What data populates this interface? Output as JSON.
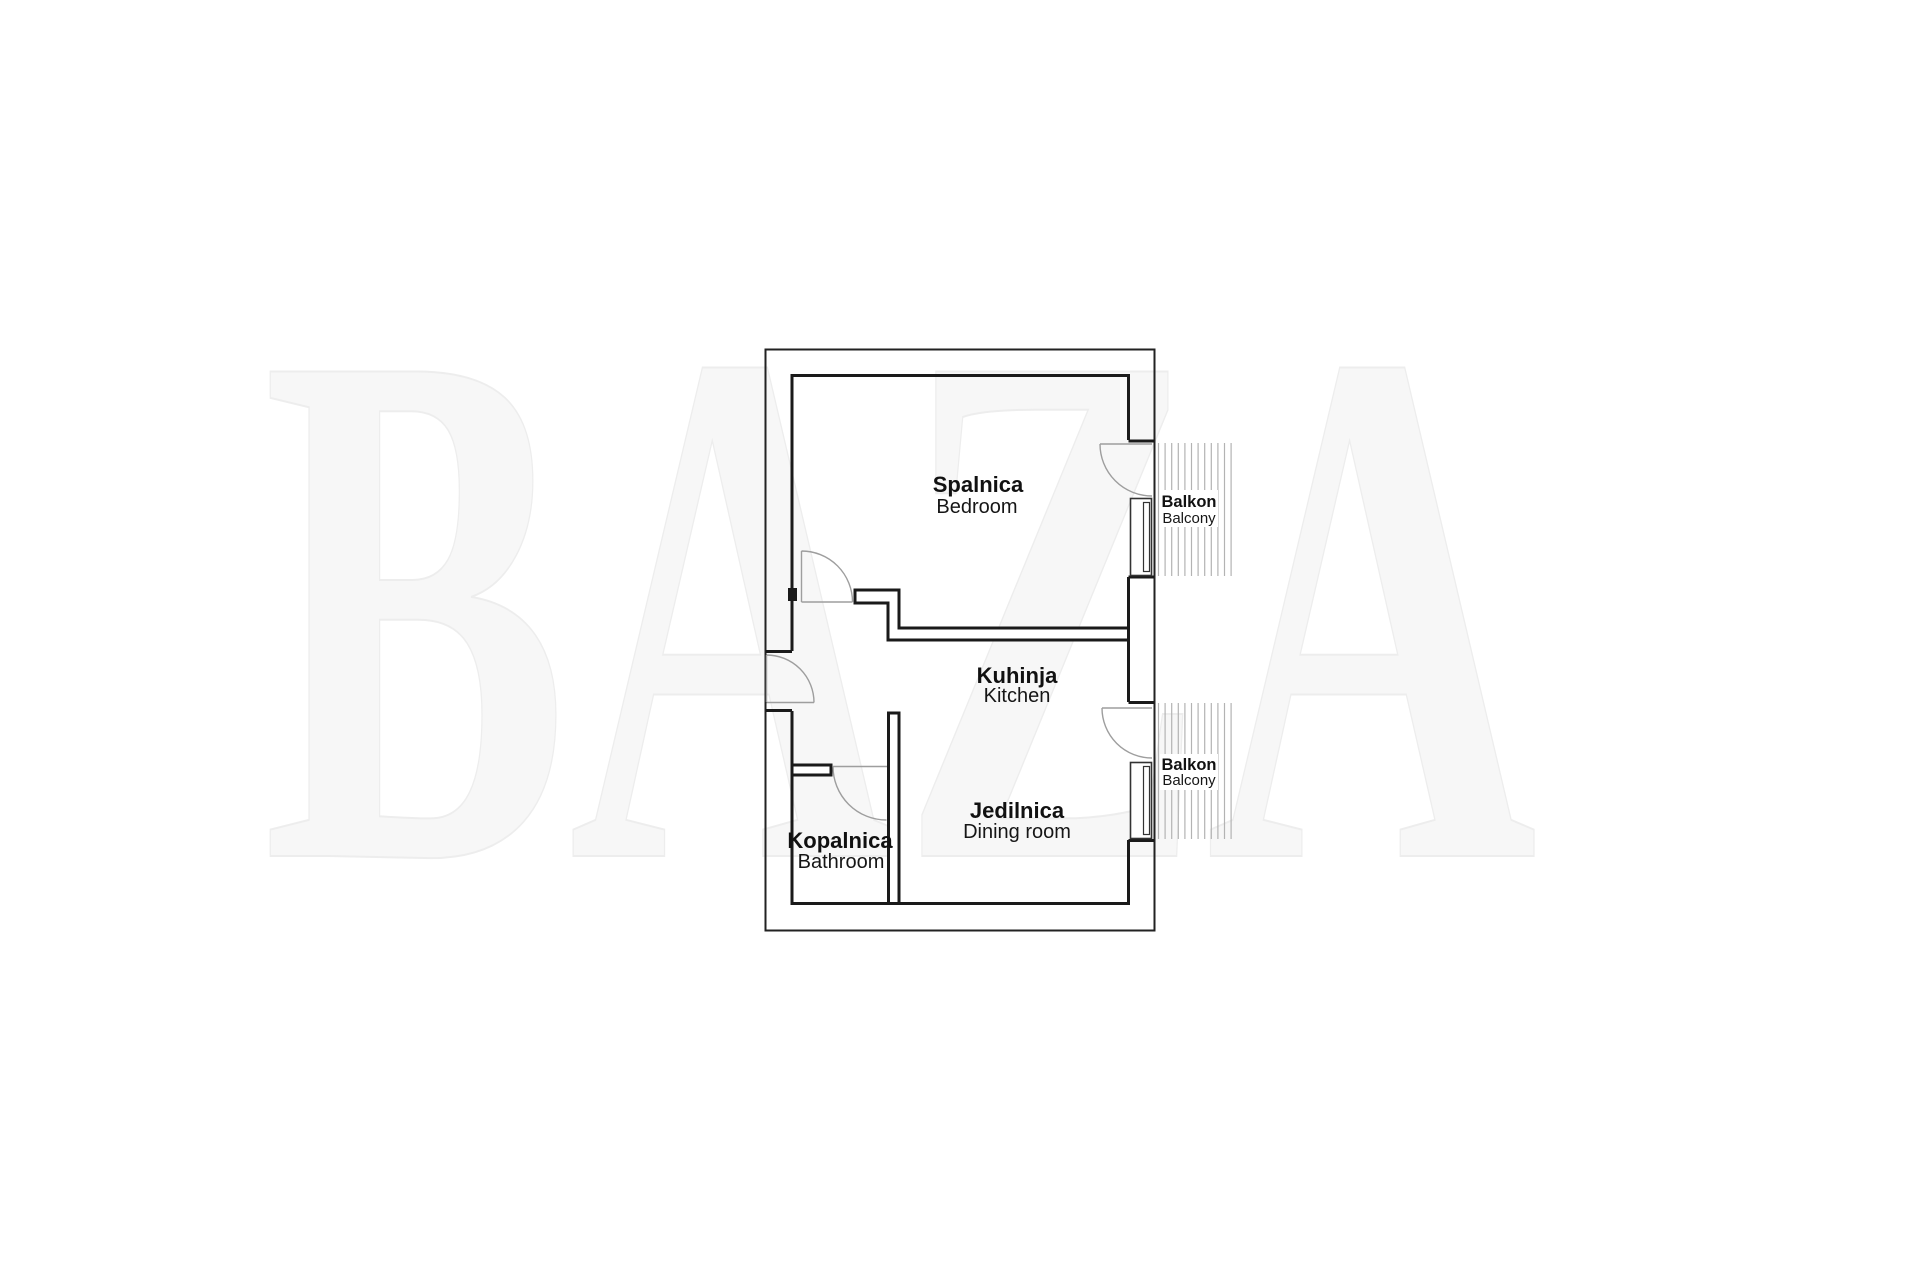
{
  "watermark_text": "BAZA",
  "rooms": {
    "bedroom": {
      "sl": "Spalnica",
      "en": "Bedroom"
    },
    "kitchen": {
      "sl": "Kuhinja",
      "en": "Kitchen"
    },
    "dining": {
      "sl": "Jedilnica",
      "en": "Dining room"
    },
    "bathroom": {
      "sl": "Kopalnica",
      "en": "Bathroom"
    }
  },
  "balconies": {
    "top": {
      "sl": "Balkon",
      "en": "Balcony"
    },
    "bottom": {
      "sl": "Balkon",
      "en": "Balcony"
    }
  },
  "colors": {
    "wall": "#1a1a1a",
    "outer_line": "#222222",
    "door_arc": "#9e9e9e",
    "hatch": "#b3b3b3",
    "watermark_fill": "#f7f7f7",
    "background": "#ffffff"
  }
}
